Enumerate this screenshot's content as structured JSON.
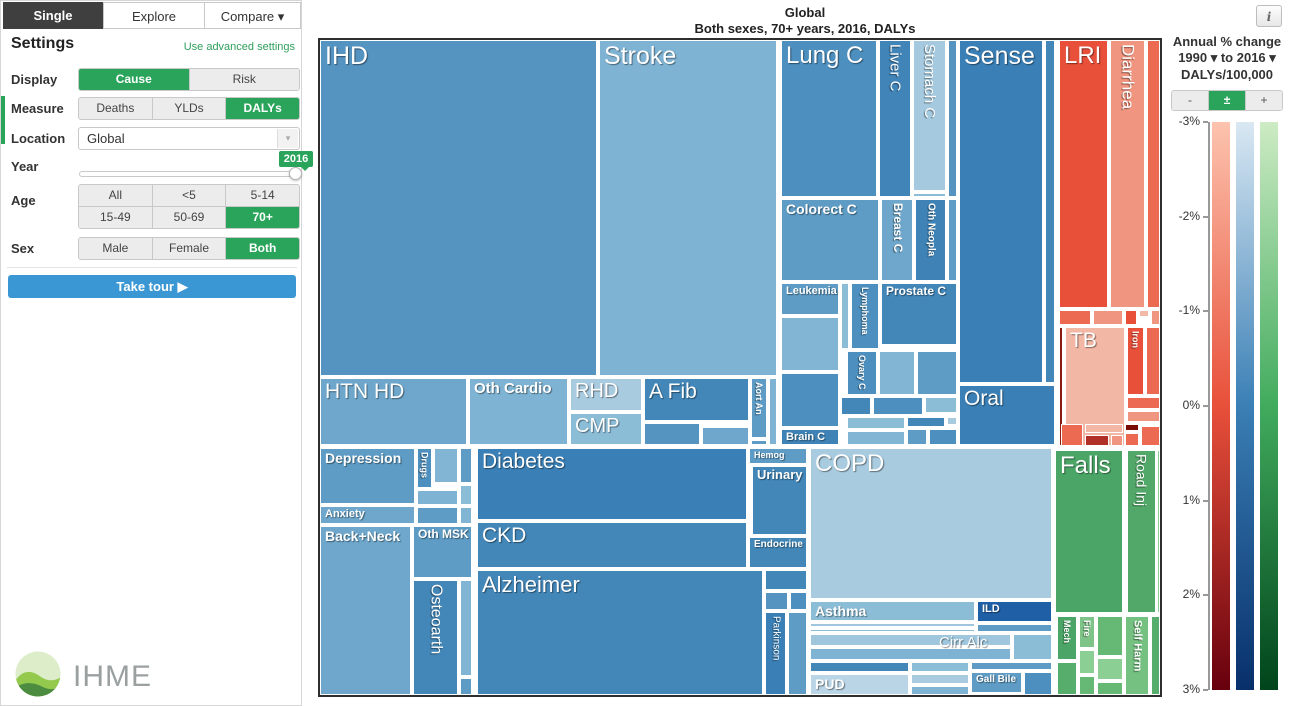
{
  "tabs": [
    "Single",
    "Explore",
    "Compare ▾"
  ],
  "icons": {
    "dropdown": "▾"
  },
  "settings": {
    "title": "Settings",
    "advanced_link": "Use advanced settings",
    "display": {
      "label": "Display",
      "options": [
        "Cause",
        "Risk"
      ],
      "selected": "Cause"
    },
    "measure": {
      "label": "Measure",
      "options": [
        "Deaths",
        "YLDs",
        "DALYs"
      ],
      "selected": "DALYs"
    },
    "location": {
      "label": "Location",
      "value": "Global"
    },
    "year": {
      "label": "Year",
      "value": "2016"
    },
    "age": {
      "label": "Age",
      "options": [
        "All",
        "<5",
        "5-14",
        "15-49",
        "50-69",
        "70+"
      ],
      "selected": "70+"
    },
    "sex": {
      "label": "Sex",
      "options": [
        "Male",
        "Female",
        "Both"
      ],
      "selected": "Both"
    },
    "tour_button": "Take tour ▶"
  },
  "logo_text": "IHME",
  "chart": {
    "title": "Global",
    "subtitle": "Both sexes, 70+ years, 2016, DALYs",
    "info_icon": "i"
  },
  "legend": {
    "title_line1": "Annual % change",
    "title_line2": "1990 ▾ to 2016 ▾",
    "title_line3": "DALYs/100,000",
    "buttons": [
      "-",
      "±",
      "+"
    ],
    "selected_button": "±",
    "ticks": [
      "-3%",
      "-2%",
      "-1%",
      "0%",
      "1%",
      "2%",
      "3%"
    ],
    "bars": [
      {
        "name": "communicable-red",
        "stops": [
          "#fcc3ae",
          "#e8503a",
          "#67000d"
        ]
      },
      {
        "name": "noncommunicable-blue",
        "stops": [
          "#d9e8f3",
          "#3a7fb5",
          "#08306b"
        ]
      },
      {
        "name": "injuries-green",
        "stops": [
          "#cdebc4",
          "#41ab5d",
          "#00441b"
        ]
      }
    ]
  },
  "chart_data": {
    "type": "treemap",
    "title": "Global",
    "subtitle": "Both sexes, 70+ years, 2016, DALYs",
    "measure": "DALYs",
    "location": "Global",
    "year": 2016,
    "age": "70+ years",
    "sex": "Both sexes",
    "color_scale": {
      "label": "Annual % change 1990 to 2016, DALYs/100,000",
      "range_percent": [
        -3,
        3
      ],
      "ticks": [
        "-3%",
        "-2%",
        "-1%",
        "0%",
        "1%",
        "2%",
        "3%"
      ]
    },
    "canvas": {
      "width": 840,
      "height": 655
    },
    "cells": [
      {
        "l": "IHD",
        "c": "#5593c1",
        "x": 0,
        "y": 0,
        "w": 277,
        "h": 336,
        "fs": 25
      },
      {
        "l": "Stroke",
        "c": "#7fb3d3",
        "x": 279,
        "y": 0,
        "w": 178,
        "h": 336,
        "fs": 25
      },
      {
        "l": "HTN HD",
        "c": "#6ea7cb",
        "x": 0,
        "y": 338,
        "w": 147,
        "h": 67,
        "fs": 21
      },
      {
        "l": "Oth Cardio",
        "c": "#7fb3d3",
        "x": 149,
        "y": 338,
        "w": 99,
        "h": 67,
        "fs": 15,
        "b": 1
      },
      {
        "l": "RHD",
        "c": "#a9cbdf",
        "x": 250,
        "y": 338,
        "w": 72,
        "h": 33,
        "fs": 20
      },
      {
        "l": "CMP",
        "c": "#8cbdd7",
        "x": 250,
        "y": 373,
        "w": 72,
        "h": 32,
        "fs": 20
      },
      {
        "l": "A Fib",
        "c": "#4387b9",
        "x": 324,
        "y": 338,
        "w": 105,
        "h": 43,
        "fs": 21
      },
      {
        "c": "#5593c1",
        "x": 324,
        "y": 383,
        "w": 56,
        "h": 22
      },
      {
        "c": "#6ea7cb",
        "x": 382,
        "y": 387,
        "w": 47,
        "h": 18
      },
      {
        "l": "Aort An",
        "c": "#5e9cc5",
        "x": 431,
        "y": 338,
        "w": 16,
        "h": 60,
        "fs": 9,
        "v": 1,
        "b": 1
      },
      {
        "c": "#5e9cc5",
        "x": 431,
        "y": 400,
        "w": 16,
        "h": 5
      },
      {
        "c": "#7fb3d3",
        "x": 449,
        "y": 338,
        "w": 8,
        "h": 67
      },
      {
        "l": "Lung C",
        "c": "#4d8fbe",
        "x": 461,
        "y": 0,
        "w": 96,
        "h": 157,
        "fs": 24
      },
      {
        "l": "Liver C",
        "c": "#4184b8",
        "x": 559,
        "y": 0,
        "w": 32,
        "h": 157,
        "fs": 15,
        "v": 1
      },
      {
        "l": "Stomach C",
        "c": "#a5c9de",
        "x": 593,
        "y": 0,
        "w": 33,
        "h": 151,
        "fs": 15,
        "v": 1
      },
      {
        "c": "#8cbdd7",
        "x": 593,
        "y": 153,
        "w": 33,
        "h": 4
      },
      {
        "c": "#5593c1",
        "x": 628,
        "y": 0,
        "w": 9,
        "h": 157
      },
      {
        "l": "Colorect C",
        "c": "#5e9cc5",
        "x": 461,
        "y": 159,
        "w": 98,
        "h": 82,
        "fs": 14,
        "b": 1
      },
      {
        "l": "Breast C",
        "c": "#6ea7cb",
        "x": 561,
        "y": 159,
        "w": 32,
        "h": 82,
        "fs": 12,
        "v": 1,
        "b": 1
      },
      {
        "l": "Oth Neopla",
        "c": "#3f83b6",
        "x": 595,
        "y": 159,
        "w": 31,
        "h": 82,
        "fs": 10,
        "v": 1,
        "b": 1
      },
      {
        "c": "#5e9cc5",
        "x": 628,
        "y": 159,
        "w": 9,
        "h": 82
      },
      {
        "l": "Leukemia",
        "c": "#5e9cc5",
        "x": 461,
        "y": 243,
        "w": 58,
        "h": 32,
        "fs": 11,
        "b": 1
      },
      {
        "c": "#82b4d3",
        "x": 461,
        "y": 277,
        "w": 58,
        "h": 54
      },
      {
        "c": "#4d8fbe",
        "x": 461,
        "y": 333,
        "w": 58,
        "h": 54
      },
      {
        "l": "Brain C",
        "c": "#3f83b6",
        "x": 461,
        "y": 389,
        "w": 58,
        "h": 16,
        "fs": 11,
        "b": 1
      },
      {
        "c": "#8cbdd7",
        "x": 521,
        "y": 243,
        "w": 8,
        "h": 66
      },
      {
        "l": "Lymphoma",
        "c": "#4d8fbe",
        "x": 531,
        "y": 243,
        "w": 28,
        "h": 66,
        "fs": 9,
        "v": 1,
        "b": 1
      },
      {
        "l": "Prostate C",
        "c": "#4387b9",
        "x": 561,
        "y": 243,
        "w": 76,
        "h": 62,
        "fs": 12,
        "b": 1
      },
      {
        "l": "Ovary C",
        "c": "#4d8fbe",
        "x": 527,
        "y": 311,
        "w": 30,
        "h": 44,
        "fs": 9,
        "v": 1,
        "b": 1
      },
      {
        "c": "#82b4d3",
        "x": 559,
        "y": 311,
        "w": 36,
        "h": 44
      },
      {
        "c": "#5e9cc5",
        "x": 597,
        "y": 311,
        "w": 40,
        "h": 44
      },
      {
        "c": "#4387b9",
        "x": 521,
        "y": 357,
        "w": 30,
        "h": 18
      },
      {
        "c": "#4d8fbe",
        "x": 553,
        "y": 357,
        "w": 50,
        "h": 18
      },
      {
        "c": "#8cbdd7",
        "x": 605,
        "y": 357,
        "w": 32,
        "h": 16
      },
      {
        "c": "#8cbdd7",
        "x": 527,
        "y": 377,
        "w": 58,
        "h": 12
      },
      {
        "c": "#4387b9",
        "x": 587,
        "y": 377,
        "w": 38,
        "h": 10
      },
      {
        "c": "#a9cbdf",
        "x": 627,
        "y": 377,
        "w": 10,
        "h": 8
      },
      {
        "c": "#82b4d3",
        "x": 527,
        "y": 391,
        "w": 58,
        "h": 14
      },
      {
        "c": "#5e9cc5",
        "x": 587,
        "y": 389,
        "w": 20,
        "h": 16
      },
      {
        "c": "#4d8fbe",
        "x": 609,
        "y": 389,
        "w": 28,
        "h": 16
      },
      {
        "l": "Sense",
        "c": "#3a7fb5",
        "x": 639,
        "y": 0,
        "w": 84,
        "h": 343,
        "fs": 25
      },
      {
        "c": "#4387b9",
        "x": 725,
        "y": 0,
        "w": 10,
        "h": 343
      },
      {
        "l": "Oral",
        "c": "#3a7fb5",
        "x": 639,
        "y": 345,
        "w": 96,
        "h": 60,
        "fs": 21
      },
      {
        "l": "LRI",
        "c": "#e8503a",
        "x": 739,
        "y": 0,
        "w": 49,
        "h": 268,
        "fs": 24
      },
      {
        "l": "Diarrhea",
        "c": "#f0957f",
        "x": 790,
        "y": 0,
        "w": 35,
        "h": 268,
        "fs": 17,
        "v": 1
      },
      {
        "c": "#ed6a52",
        "x": 827,
        "y": 0,
        "w": 13,
        "h": 268
      },
      {
        "c": "#ed6a52",
        "x": 739,
        "y": 270,
        "w": 32,
        "h": 15
      },
      {
        "c": "#f0957f",
        "x": 773,
        "y": 270,
        "w": 30,
        "h": 15
      },
      {
        "c": "#e8503a",
        "x": 805,
        "y": 270,
        "w": 12,
        "h": 15
      },
      {
        "c": "#f3b7a5",
        "x": 819,
        "y": 270,
        "w": 10,
        "h": 7
      },
      {
        "c": "#f0957f",
        "x": 831,
        "y": 270,
        "w": 9,
        "h": 15
      },
      {
        "c": "#8c1a10",
        "x": 739,
        "y": 287,
        "w": 4,
        "h": 119
      },
      {
        "l": "TB",
        "c": "#f3b7a5",
        "x": 745,
        "y": 287,
        "w": 60,
        "h": 119,
        "fs": 21
      },
      {
        "l": "Iron",
        "c": "#e8503a",
        "x": 807,
        "y": 287,
        "w": 17,
        "h": 68,
        "fs": 9,
        "v": 1,
        "b": 1
      },
      {
        "c": "#ed6a52",
        "x": 826,
        "y": 287,
        "w": 14,
        "h": 68
      },
      {
        "c": "#ed6a52",
        "x": 807,
        "y": 357,
        "w": 33,
        "h": 12
      },
      {
        "c": "#f0957f",
        "x": 807,
        "y": 371,
        "w": 33,
        "h": 11
      },
      {
        "c": "#ed6a52",
        "x": 741,
        "y": 384,
        "w": 22,
        "h": 22
      },
      {
        "c": "#f3b7a5",
        "x": 765,
        "y": 384,
        "w": 38,
        "h": 9
      },
      {
        "c": "#7a0c08",
        "x": 805,
        "y": 384,
        "w": 14,
        "h": 7
      },
      {
        "c": "#b03028",
        "x": 765,
        "y": 395,
        "w": 24,
        "h": 11
      },
      {
        "c": "#f0957f",
        "x": 791,
        "y": 395,
        "w": 12,
        "h": 11
      },
      {
        "c": "#ed6a52",
        "x": 805,
        "y": 393,
        "w": 14,
        "h": 13
      },
      {
        "c": "#ed6a52",
        "x": 821,
        "y": 386,
        "w": 19,
        "h": 20
      },
      {
        "l": "Falls",
        "c": "#4ba566",
        "x": 735,
        "y": 410,
        "w": 68,
        "h": 163,
        "fs": 24
      },
      {
        "l": "Road Inj",
        "c": "#52a868",
        "x": 807,
        "y": 410,
        "w": 29,
        "h": 163,
        "fs": 14,
        "v": 1
      },
      {
        "c": "#8ccf94",
        "x": 837,
        "y": 410,
        "w": 3,
        "h": 163
      },
      {
        "l": "Mech",
        "c": "#4ba566",
        "x": 737,
        "y": 576,
        "w": 20,
        "h": 44,
        "fs": 9,
        "v": 1,
        "b": 1
      },
      {
        "c": "#57ad6b",
        "x": 737,
        "y": 622,
        "w": 20,
        "h": 33
      },
      {
        "l": "Fire",
        "c": "#7ec489",
        "x": 759,
        "y": 576,
        "w": 16,
        "h": 32,
        "fs": 9,
        "v": 1,
        "b": 1
      },
      {
        "c": "#8ccf94",
        "x": 759,
        "y": 610,
        "w": 16,
        "h": 24
      },
      {
        "c": "#65b974",
        "x": 759,
        "y": 636,
        "w": 16,
        "h": 19
      },
      {
        "c": "#65b974",
        "x": 777,
        "y": 576,
        "w": 26,
        "h": 40
      },
      {
        "c": "#8ccf94",
        "x": 777,
        "y": 618,
        "w": 26,
        "h": 22
      },
      {
        "c": "#65b974",
        "x": 777,
        "y": 642,
        "w": 26,
        "h": 13
      },
      {
        "l": "Self Harm",
        "c": "#74c181",
        "x": 805,
        "y": 576,
        "w": 24,
        "h": 79,
        "fs": 11,
        "v": 1,
        "b": 1
      },
      {
        "c": "#57ad6b",
        "x": 831,
        "y": 576,
        "w": 9,
        "h": 79
      },
      {
        "l": "Depression",
        "c": "#5e9cc5",
        "x": 0,
        "y": 408,
        "w": 95,
        "h": 56,
        "fs": 14,
        "b": 1
      },
      {
        "l": "Drugs",
        "c": "#4d8fbe",
        "x": 97,
        "y": 408,
        "w": 15,
        "h": 40,
        "fs": 9,
        "v": 1,
        "b": 1
      },
      {
        "c": "#82b4d3",
        "x": 114,
        "y": 408,
        "w": 24,
        "h": 35
      },
      {
        "c": "#5e9cc5",
        "x": 140,
        "y": 408,
        "w": 12,
        "h": 35
      },
      {
        "c": "#7fb3d3",
        "x": 97,
        "y": 450,
        "w": 41,
        "h": 15
      },
      {
        "c": "#8cbdd7",
        "x": 140,
        "y": 445,
        "w": 12,
        "h": 20
      },
      {
        "l": "Anxiety",
        "c": "#6ea7cb",
        "x": 0,
        "y": 466,
        "w": 95,
        "h": 18,
        "fs": 11,
        "b": 1
      },
      {
        "c": "#5e9cc5",
        "x": 97,
        "y": 467,
        "w": 41,
        "h": 17
      },
      {
        "c": "#82b4d3",
        "x": 140,
        "y": 467,
        "w": 12,
        "h": 17
      },
      {
        "l": "Back+Neck",
        "c": "#6ea7cb",
        "x": 0,
        "y": 486,
        "w": 91,
        "h": 169,
        "fs": 14,
        "b": 1
      },
      {
        "l": "Oth MSK",
        "c": "#5e9cc5",
        "x": 93,
        "y": 486,
        "w": 59,
        "h": 52,
        "fs": 12,
        "b": 1
      },
      {
        "l": "Osteoarth",
        "c": "#4387b9",
        "x": 93,
        "y": 540,
        "w": 45,
        "h": 115,
        "fs": 16,
        "v": 1
      },
      {
        "c": "#82b4d3",
        "x": 140,
        "y": 540,
        "w": 12,
        "h": 96
      },
      {
        "c": "#5e9cc5",
        "x": 140,
        "y": 638,
        "w": 12,
        "h": 17
      },
      {
        "l": "Diabetes",
        "c": "#3a7fb5",
        "x": 157,
        "y": 408,
        "w": 270,
        "h": 72,
        "fs": 21
      },
      {
        "l": "Hemog",
        "c": "#5e9cc5",
        "x": 429,
        "y": 408,
        "w": 58,
        "h": 16,
        "fs": 9,
        "b": 1
      },
      {
        "l": "Urinary",
        "c": "#4387b9",
        "x": 432,
        "y": 426,
        "w": 55,
        "h": 69,
        "fs": 13,
        "b": 1
      },
      {
        "l": "CKD",
        "c": "#4387b9",
        "x": 157,
        "y": 482,
        "w": 270,
        "h": 46,
        "fs": 21
      },
      {
        "l": "Endocrine",
        "c": "#4387b9",
        "x": 429,
        "y": 497,
        "w": 58,
        "h": 31,
        "fs": 10,
        "b": 1
      },
      {
        "l": "Alzheimer",
        "c": "#4387b9",
        "x": 157,
        "y": 530,
        "w": 286,
        "h": 125,
        "fs": 22
      },
      {
        "c": "#4387b9",
        "x": 445,
        "y": 530,
        "w": 42,
        "h": 20
      },
      {
        "c": "#5593c1",
        "x": 445,
        "y": 552,
        "w": 23,
        "h": 18
      },
      {
        "c": "#4d8fbe",
        "x": 470,
        "y": 552,
        "w": 17,
        "h": 18
      },
      {
        "l": "Parkinson",
        "c": "#3a7fb5",
        "x": 445,
        "y": 572,
        "w": 21,
        "h": 83,
        "fs": 10,
        "v": 1
      },
      {
        "c": "#5e9cc5",
        "x": 468,
        "y": 572,
        "w": 19,
        "h": 83
      },
      {
        "l": "COPD",
        "c": "#a9cbdf",
        "x": 490,
        "y": 408,
        "w": 242,
        "h": 151,
        "fs": 24
      },
      {
        "l": "Asthma",
        "c": "#8cbdd7",
        "x": 490,
        "y": 561,
        "w": 165,
        "h": 20,
        "fs": 14,
        "b": 1
      },
      {
        "c": "#9fc6dc",
        "x": 490,
        "y": 583,
        "w": 165,
        "h": 4
      },
      {
        "c": "#8cbdd7",
        "x": 490,
        "y": 589,
        "w": 165,
        "h": 3
      },
      {
        "l": "ILD",
        "c": "#1e5fa6",
        "x": 657,
        "y": 561,
        "w": 75,
        "h": 21,
        "fs": 11,
        "b": 1
      },
      {
        "c": "#5e9cc5",
        "x": 657,
        "y": 584,
        "w": 75,
        "h": 8
      },
      {
        "c": "#9fc6dc",
        "x": 490,
        "y": 594,
        "w": 201,
        "h": 12
      },
      {
        "c": "#7fb3d3",
        "x": 490,
        "y": 608,
        "w": 201,
        "h": 12
      },
      {
        "l": "Cirr Alc",
        "c": "",
        "x": 615,
        "y": 593,
        "w": 75,
        "h": 27,
        "fs": 15
      },
      {
        "c": "#8cbdd7",
        "x": 693,
        "y": 594,
        "w": 39,
        "h": 26
      },
      {
        "c": "#4387b9",
        "x": 490,
        "y": 622,
        "w": 99,
        "h": 10
      },
      {
        "l": "PUD",
        "c": "#b9d5e6",
        "x": 490,
        "y": 634,
        "w": 99,
        "h": 21,
        "fs": 14,
        "b": 1
      },
      {
        "c": "#8cbdd7",
        "x": 591,
        "y": 622,
        "w": 58,
        "h": 10
      },
      {
        "c": "#a9cbdf",
        "x": 591,
        "y": 634,
        "w": 58,
        "h": 10
      },
      {
        "c": "#7fb3d3",
        "x": 591,
        "y": 646,
        "w": 58,
        "h": 9
      },
      {
        "c": "#5e9cc5",
        "x": 651,
        "y": 622,
        "w": 81,
        "h": 8
      },
      {
        "l": "Gall Bile",
        "c": "#5e9cc5",
        "x": 651,
        "y": 632,
        "w": 51,
        "h": 21,
        "fs": 10,
        "b": 1
      },
      {
        "c": "#4d8fbe",
        "x": 704,
        "y": 632,
        "w": 28,
        "h": 23
      }
    ]
  }
}
